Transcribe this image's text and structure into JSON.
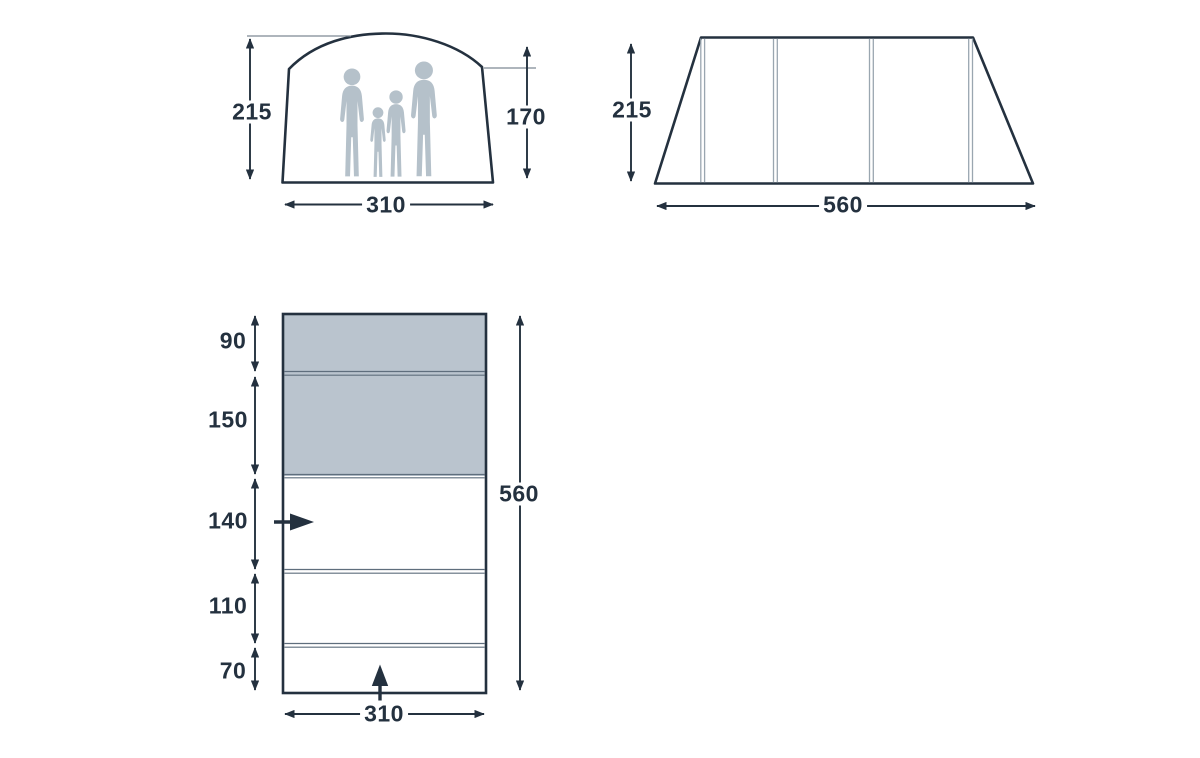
{
  "diagram_title": "tent dimensions diagram",
  "units_shown": "centimeters (implied, unlabeled)",
  "colors": {
    "background": "#ffffff",
    "outline": "#24313f",
    "dimension_line": "#24313f",
    "extension_line": "#7e8994",
    "shade_fill": "#bac4ce",
    "pole_line": "#9aa6b0",
    "divider_line": "#5f6e7d",
    "silhouette": "#b5c1ca"
  },
  "front_view": {
    "peak_height": "215",
    "wall_height": "170",
    "width": "310"
  },
  "side_view": {
    "height": "215",
    "length": "560"
  },
  "floor_plan": {
    "section_depths": [
      "90",
      "150",
      "140",
      "110",
      "70"
    ],
    "shaded_sections": [
      "90",
      "150"
    ],
    "total_depth": "560",
    "width": "310"
  }
}
